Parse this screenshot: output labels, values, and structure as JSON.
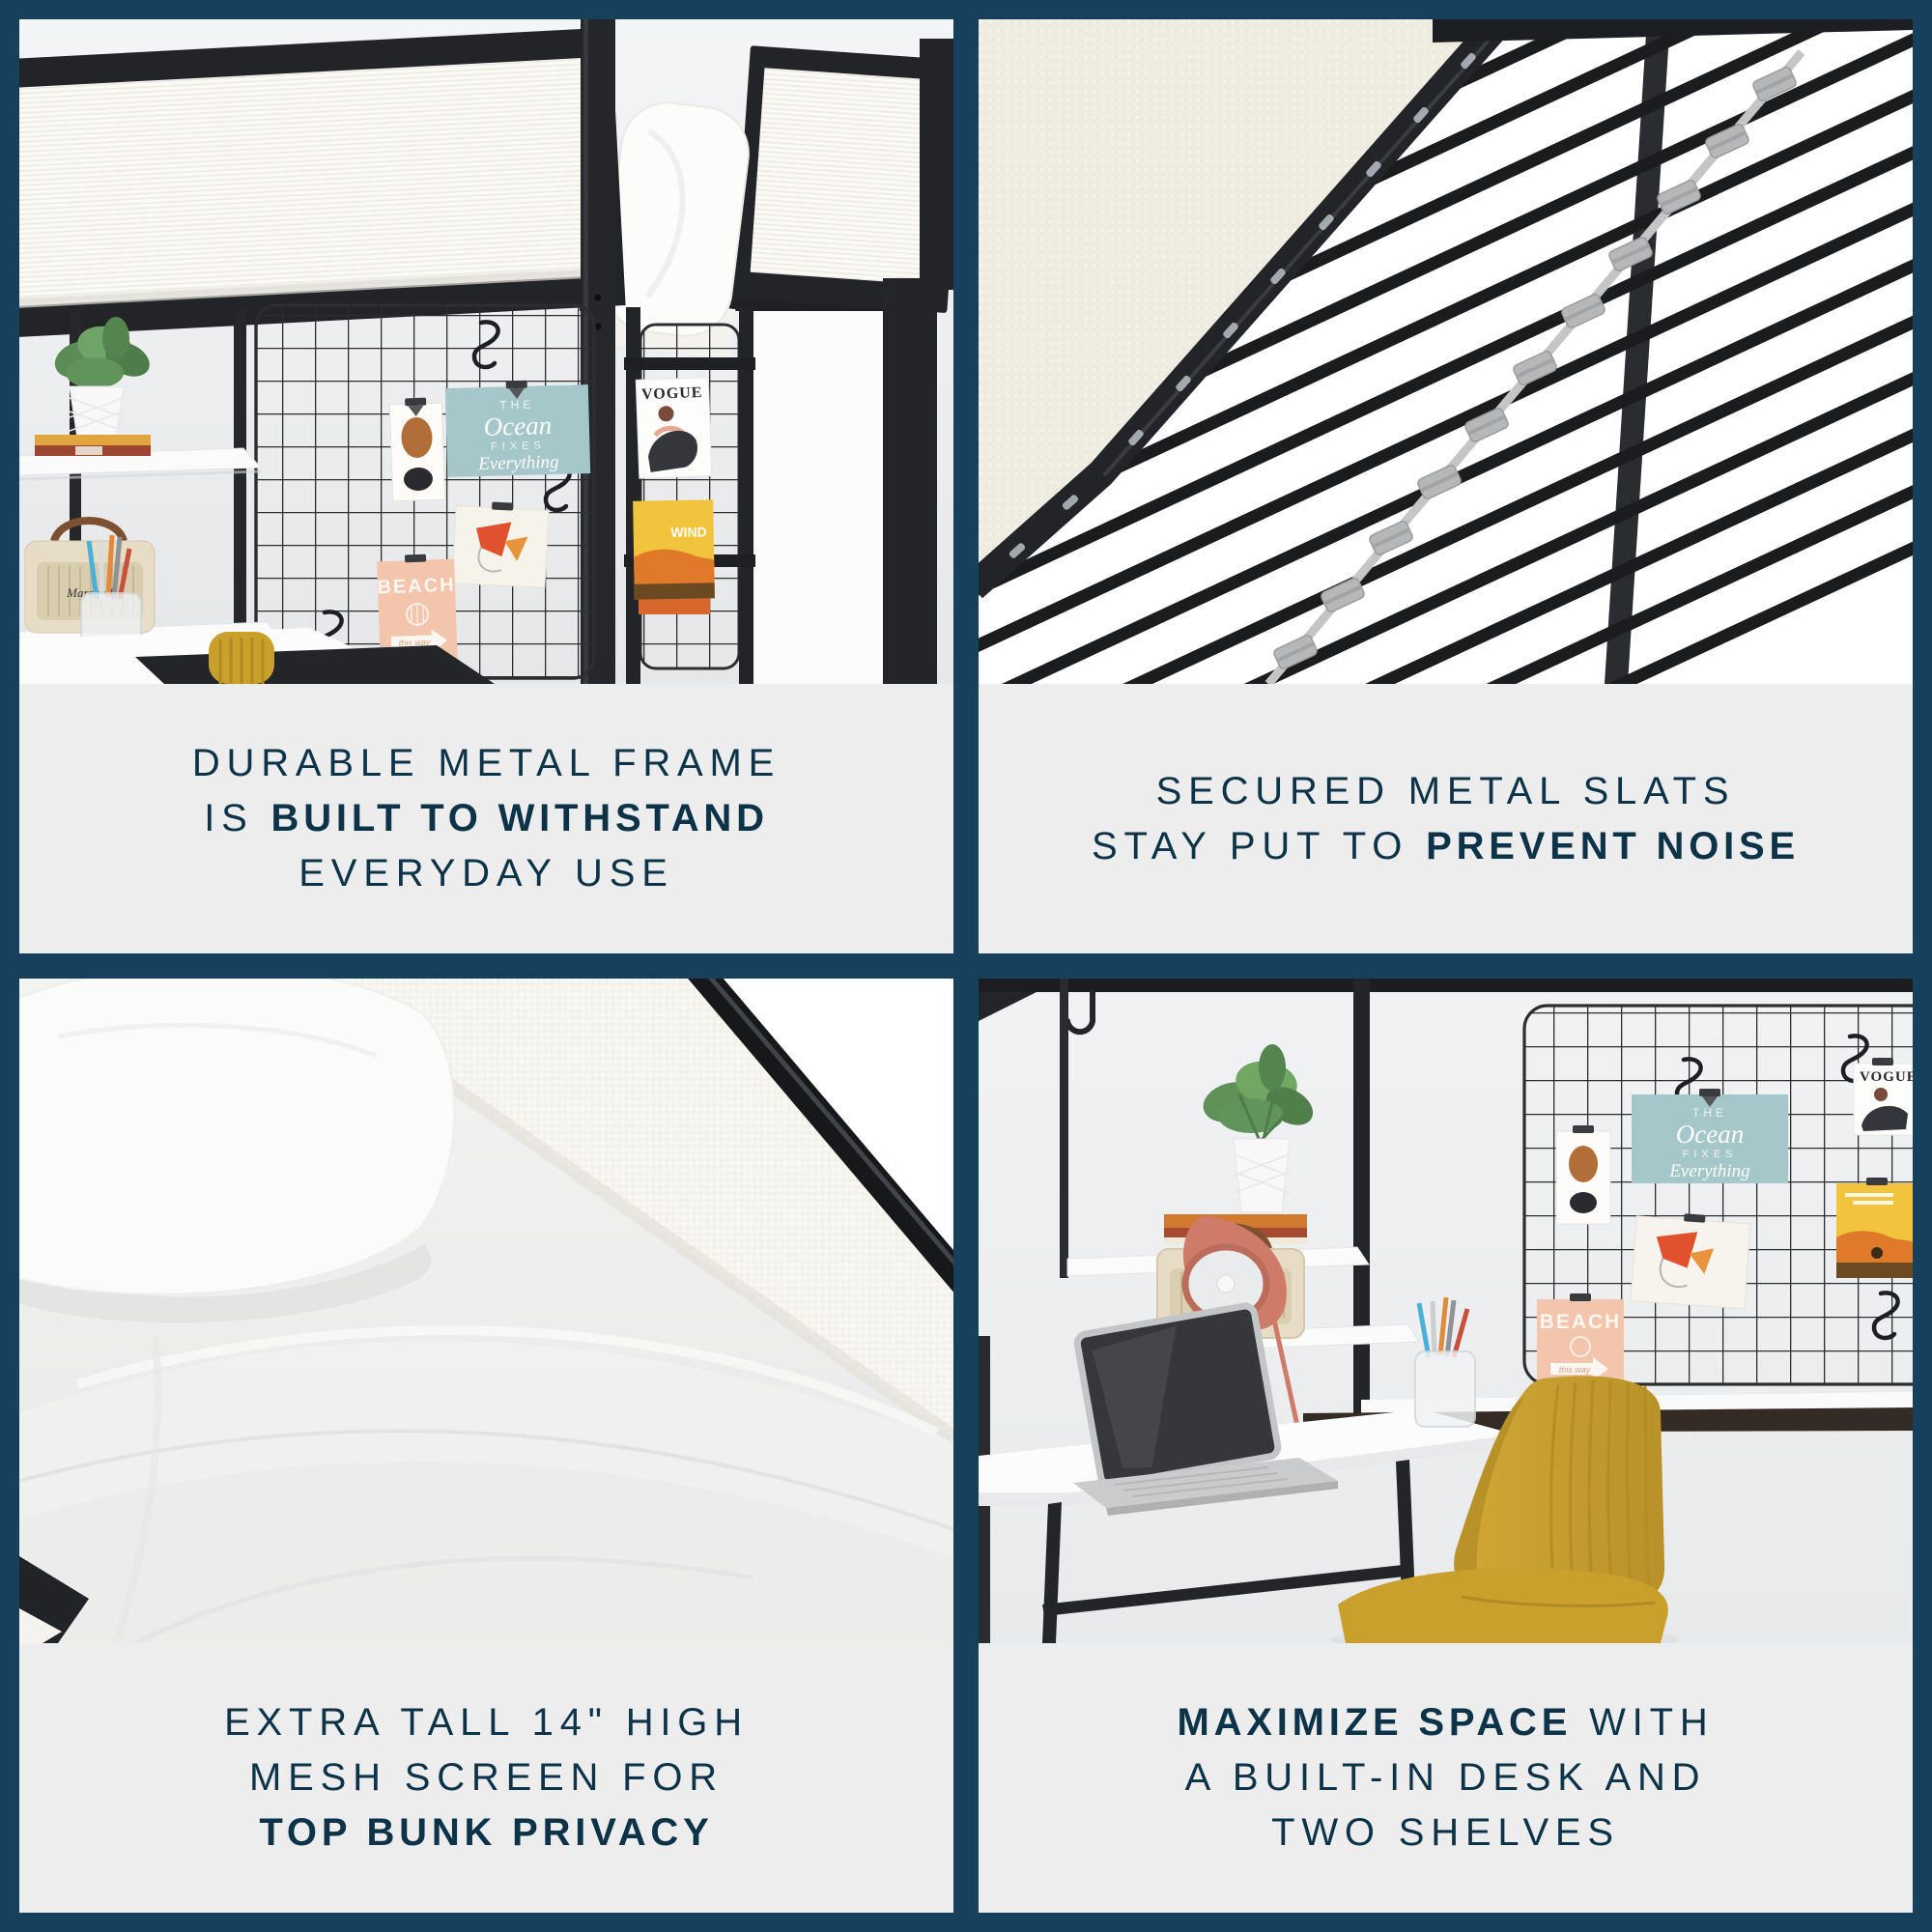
{
  "colors": {
    "border_navy": "#17405c",
    "caption_bg": "#ededee",
    "caption_text": "#0d3349",
    "frame_black": "#232428",
    "chair_mustard": "#c9a02c",
    "lamp_coral": "#cf7b69",
    "poster_teal": "#a5c7ca",
    "poster_peach": "#f3c5ac",
    "radio_cream": "#e7ddc6",
    "slat_clip_gray": "#b5b7b8"
  },
  "panels": [
    {
      "id": "durable-frame",
      "caption": {
        "lines": [
          {
            "pre": "DURABLE METAL FRAME"
          },
          {
            "pre": "IS ",
            "bold": "BUILT TO WITHSTAND"
          },
          {
            "pre": "EVERYDAY USE"
          }
        ]
      }
    },
    {
      "id": "metal-slats",
      "caption": {
        "lines": [
          {
            "pre": "SECURED METAL SLATS"
          },
          {
            "pre": "STAY PUT TO ",
            "bold": "PREVENT NOISE"
          }
        ]
      }
    },
    {
      "id": "mesh-screen",
      "caption": {
        "lines": [
          {
            "pre": "EXTRA TALL 14\" HIGH"
          },
          {
            "pre": "MESH SCREEN FOR"
          },
          {
            "bold": "TOP BUNK PRIVACY"
          }
        ]
      }
    },
    {
      "id": "built-in-desk",
      "caption": {
        "lines": [
          {
            "bold": "MAXIMIZE SPACE",
            "post": " WITH"
          },
          {
            "pre": "A BUILT-IN DESK AND"
          },
          {
            "pre": "TWO SHELVES"
          }
        ]
      }
    }
  ],
  "decor": {
    "ocean_poster": {
      "line1": "THE",
      "line2": "Ocean",
      "line3": "FIXES",
      "line4": "Everything"
    },
    "beach_poster": {
      "title": "BEACH",
      "subtitle": "this way"
    },
    "vogue_poster": {
      "title": "VOGUE"
    },
    "wind_poster": {
      "title": "WIND"
    },
    "radio_brand": "Marshall"
  }
}
